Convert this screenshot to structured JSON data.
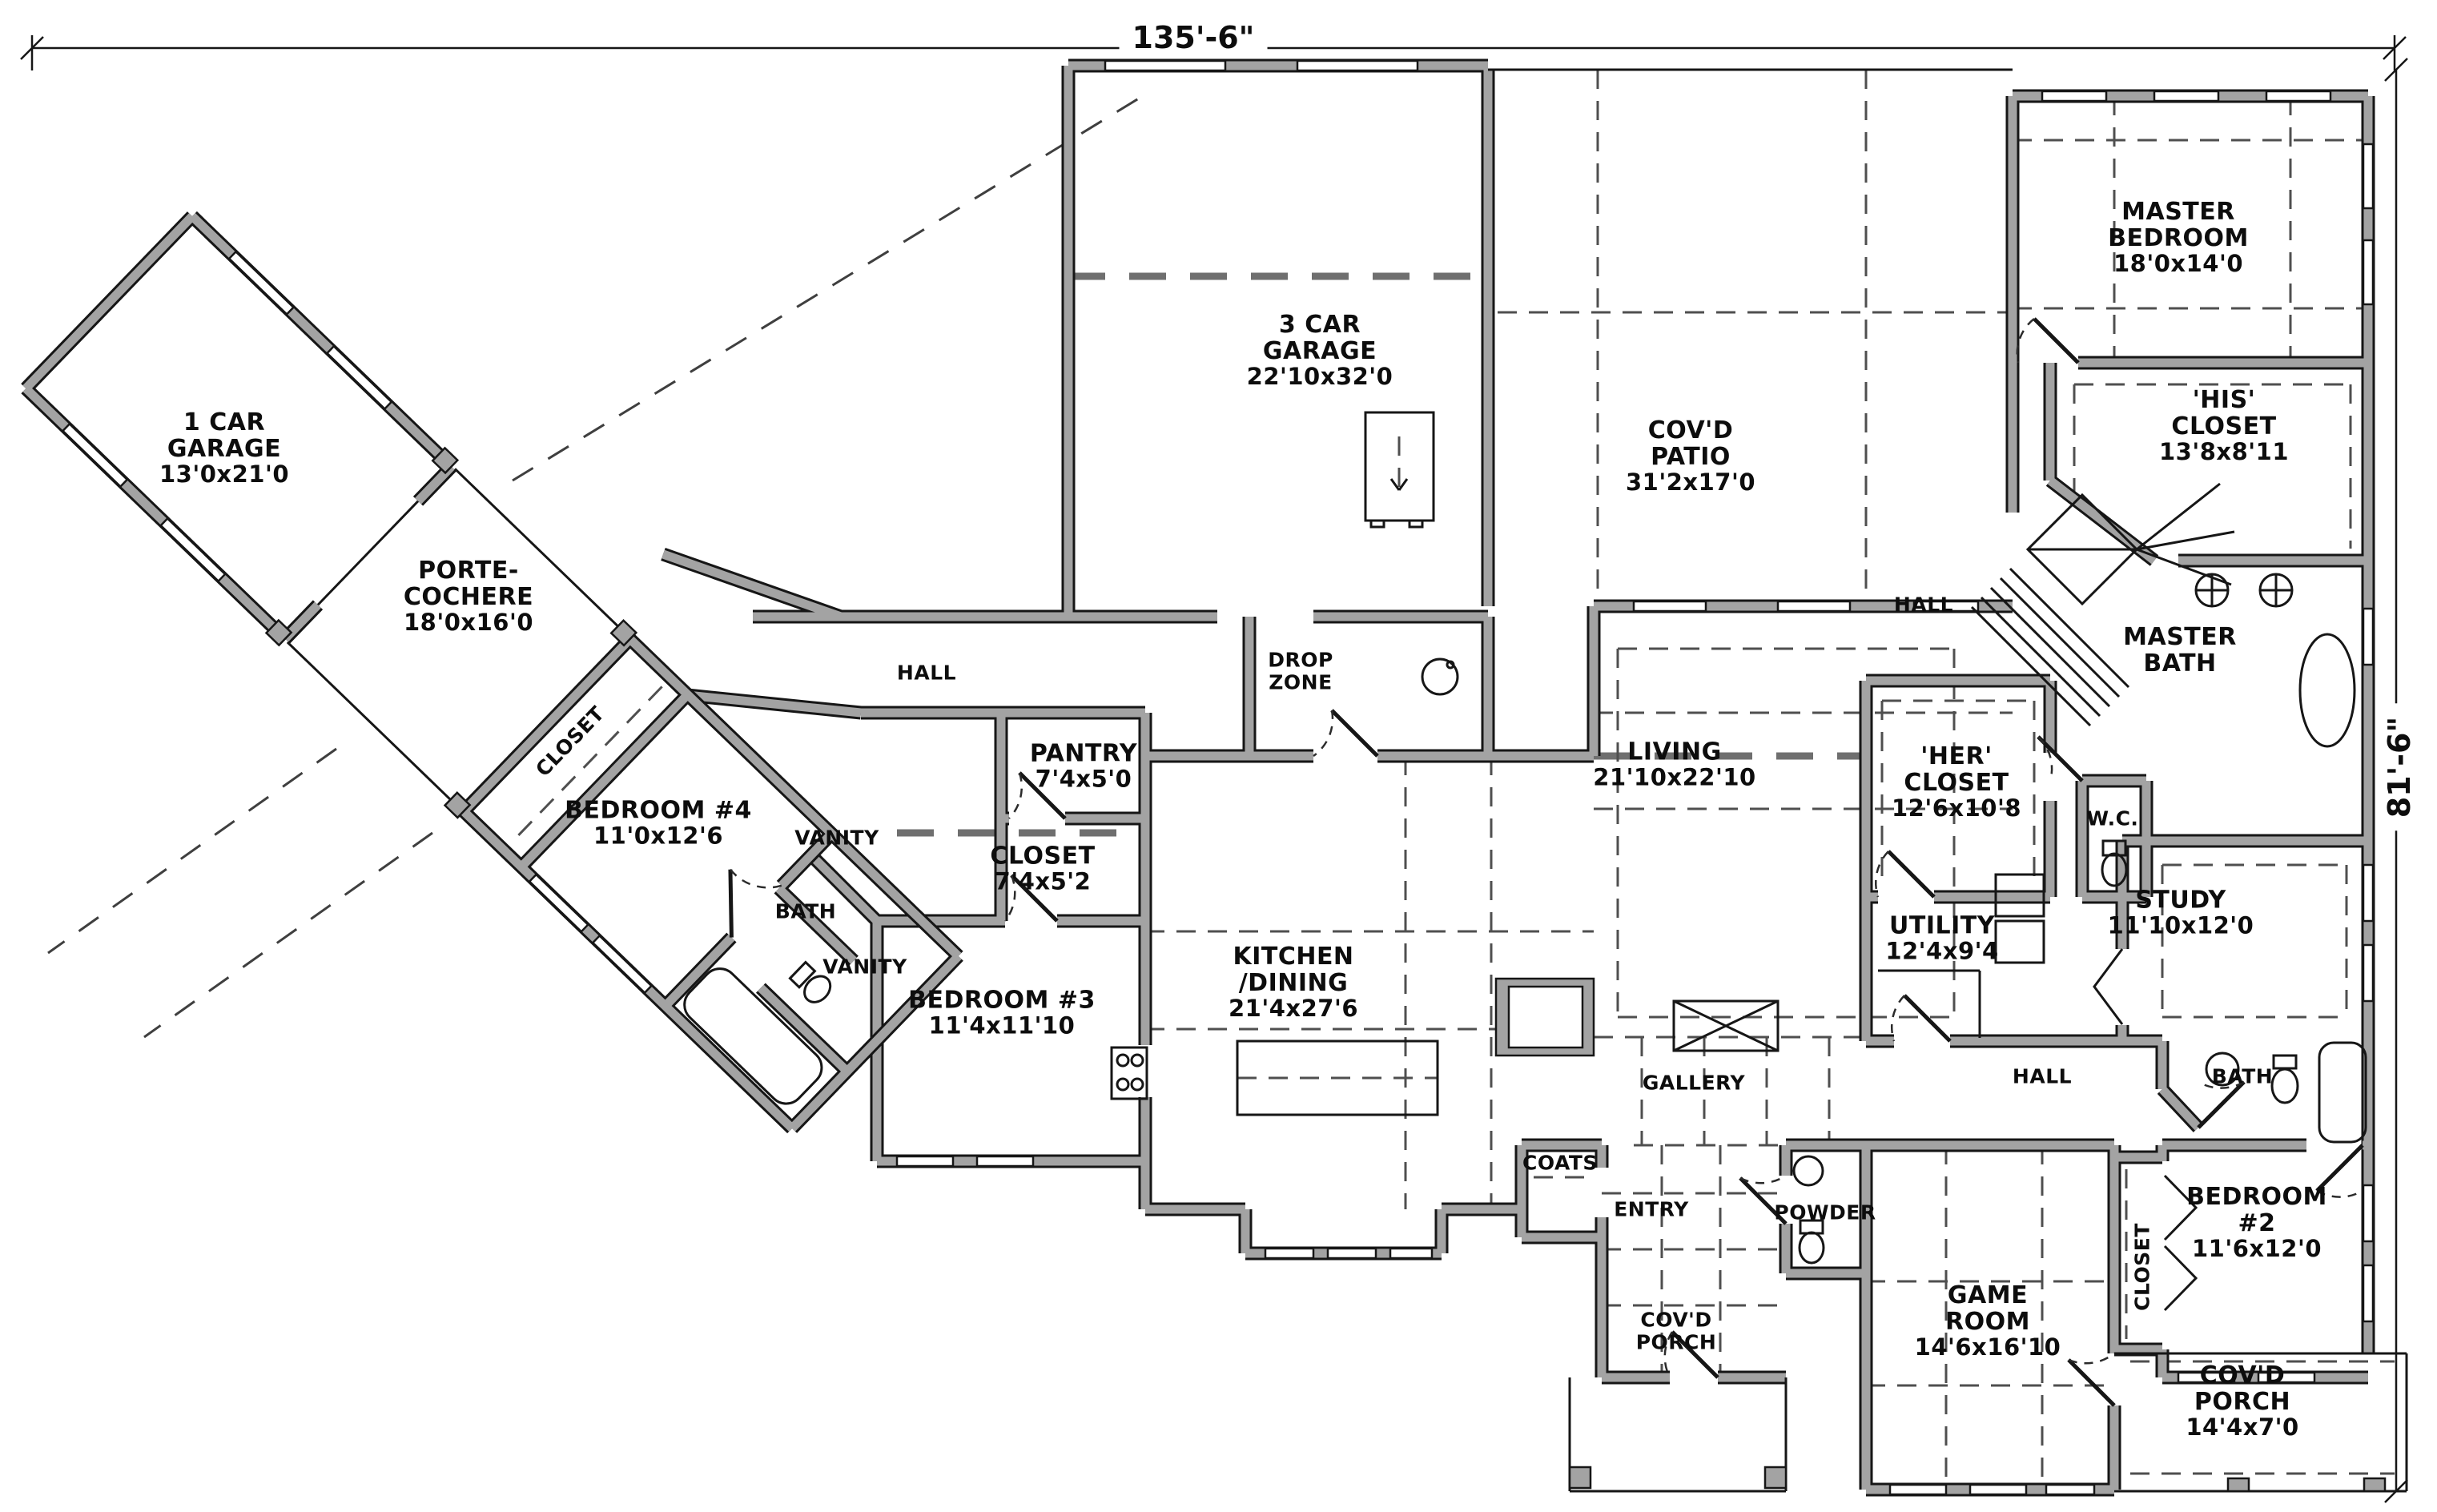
{
  "sheet": {
    "type": "residential-floor-plan",
    "overall_dimensions": {
      "width_label": "135'-6\"",
      "height_label": "81'-6\""
    }
  },
  "rooms": [
    {
      "name": "1 CAR\nGARAGE",
      "size": "13'0x21'0"
    },
    {
      "name": "PORTE-\nCOCHERE",
      "size": "18'0x16'0"
    },
    {
      "name": "CLOSET"
    },
    {
      "name": "BEDROOM #4",
      "size": "11'0x12'6"
    },
    {
      "name": "VANITY"
    },
    {
      "name": "BATH"
    },
    {
      "name": "VANITY"
    },
    {
      "name": "BEDROOM #3",
      "size": "11'4x11'10"
    },
    {
      "name": "HALL"
    },
    {
      "name": "PANTRY",
      "size": "7'4x5'0"
    },
    {
      "name": "CLOSET",
      "size": "7'4x5'2"
    },
    {
      "name": "DROP\nZONE"
    },
    {
      "name": "3 CAR\nGARAGE",
      "size": "22'10x32'0"
    },
    {
      "name": "COV'D\nPATIO",
      "size": "31'2x17'0"
    },
    {
      "name": "MASTER\nBEDROOM",
      "size": "18'0x14'0"
    },
    {
      "name": "'HIS'\nCLOSET",
      "size": "13'8x8'11"
    },
    {
      "name": "HALL"
    },
    {
      "name": "MASTER\nBATH"
    },
    {
      "name": "'HER'\nCLOSET",
      "size": "12'6x10'8"
    },
    {
      "name": "W.C."
    },
    {
      "name": "LIVING",
      "size": "21'10x22'10"
    },
    {
      "name": "KITCHEN\n/DINING",
      "size": "21'4x27'6"
    },
    {
      "name": "UTILITY",
      "size": "12'4x9'4"
    },
    {
      "name": "STUDY",
      "size": "11'10x12'0"
    },
    {
      "name": "GALLERY"
    },
    {
      "name": "HALL"
    },
    {
      "name": "BATH"
    },
    {
      "name": "COATS"
    },
    {
      "name": "ENTRY"
    },
    {
      "name": "POWDER"
    },
    {
      "name": "COV'D\nPORCH"
    },
    {
      "name": "GAME\nROOM",
      "size": "14'6x16'10"
    },
    {
      "name": "BEDROOM #2",
      "size": "11'6x12'0"
    },
    {
      "name": "CLOSET"
    },
    {
      "name": "COV'D\nPORCH",
      "size": "14'4x7'0"
    }
  ],
  "fixtures": [
    "kitchen-island",
    "fireplace",
    "refrigerator",
    "cooktop",
    "water-heater",
    "washer-dryer",
    "freestanding-tub",
    "tub",
    "toilet",
    "sink",
    "stairs",
    "mud-sink"
  ]
}
